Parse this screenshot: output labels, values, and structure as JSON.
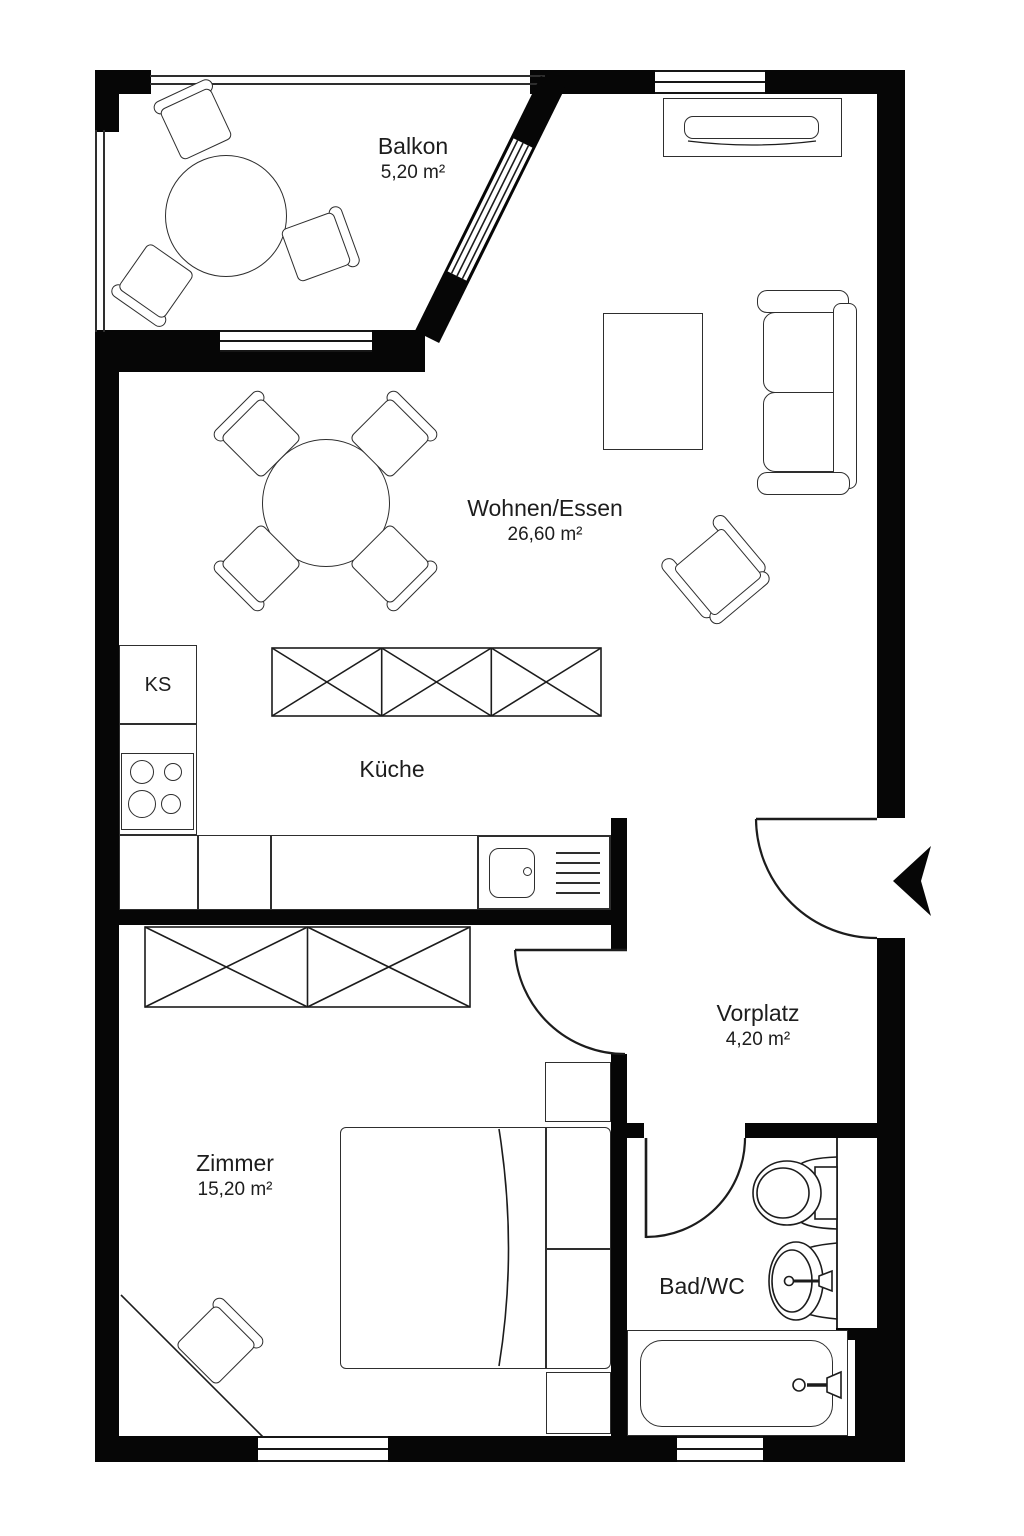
{
  "plan": {
    "type": "floor-plan",
    "rooms": [
      {
        "name": "Balkon",
        "area": "5,20 m²"
      },
      {
        "name": "Wohnen/Essen",
        "area": "26,60 m²"
      },
      {
        "name": "Küche"
      },
      {
        "name": "Vorplatz",
        "area": "4,20 m²"
      },
      {
        "name": "Zimmer",
        "area": "15,20 m²"
      },
      {
        "name": "Bad/WC"
      }
    ],
    "labels": {
      "fridge": "KS"
    },
    "icons": {
      "entrance_marker": "arrow-left"
    },
    "colors": {
      "wall": "#060606",
      "line": "#2e2e2e",
      "background": "#ffffff",
      "text": "#1d1d1d"
    }
  }
}
